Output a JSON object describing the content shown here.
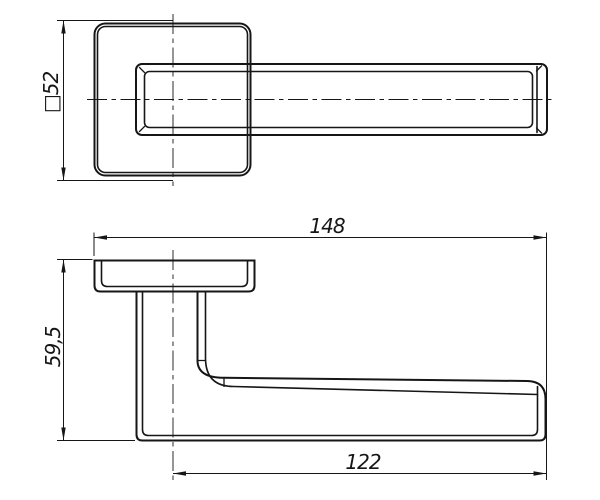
{
  "colors": {
    "background": "#ffffff",
    "line": "#161616"
  },
  "views": {
    "front": {
      "rosette_dim": "□52"
    },
    "side": {
      "length_dim": "148",
      "height_dim": "59,5",
      "grip_dim": "122"
    }
  }
}
